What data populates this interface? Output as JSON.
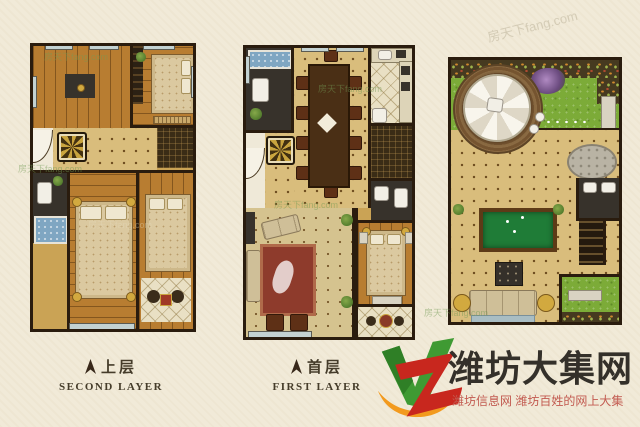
{
  "image_type": "three-level apartment floor plan poster",
  "labels": {
    "second": {
      "zh": "上层",
      "en": "SECOND LAYER"
    },
    "first": {
      "zh": "首层",
      "en": "FIRST LAYER"
    }
  },
  "logo": {
    "site_name": "潍坊大集网",
    "tagline": "潍坊信息网 潍坊百姓的网上大集",
    "mark_letters": "VZ",
    "colors": {
      "v_green": "#3f9a33",
      "z_red": "#c8271e",
      "swoosh_orange": "#f29a1e",
      "site_text": "#34302a",
      "tagline_red": "#c25a50"
    }
  },
  "watermark": {
    "text": "房天下fang.com"
  },
  "icons": {
    "north_arrow": "compass-arrow",
    "parasol": "garden-parasol",
    "medallion": "floor-medallion"
  },
  "palette": {
    "background": "#f1ead8",
    "wall": "#2a1c0e",
    "wood_floor": "#b87d31",
    "tile_floor": "#d9bd7c",
    "lawn_green": "#7cab38",
    "billiard_green": "#1f7c37",
    "tub_blue": "#7fa6c2"
  }
}
